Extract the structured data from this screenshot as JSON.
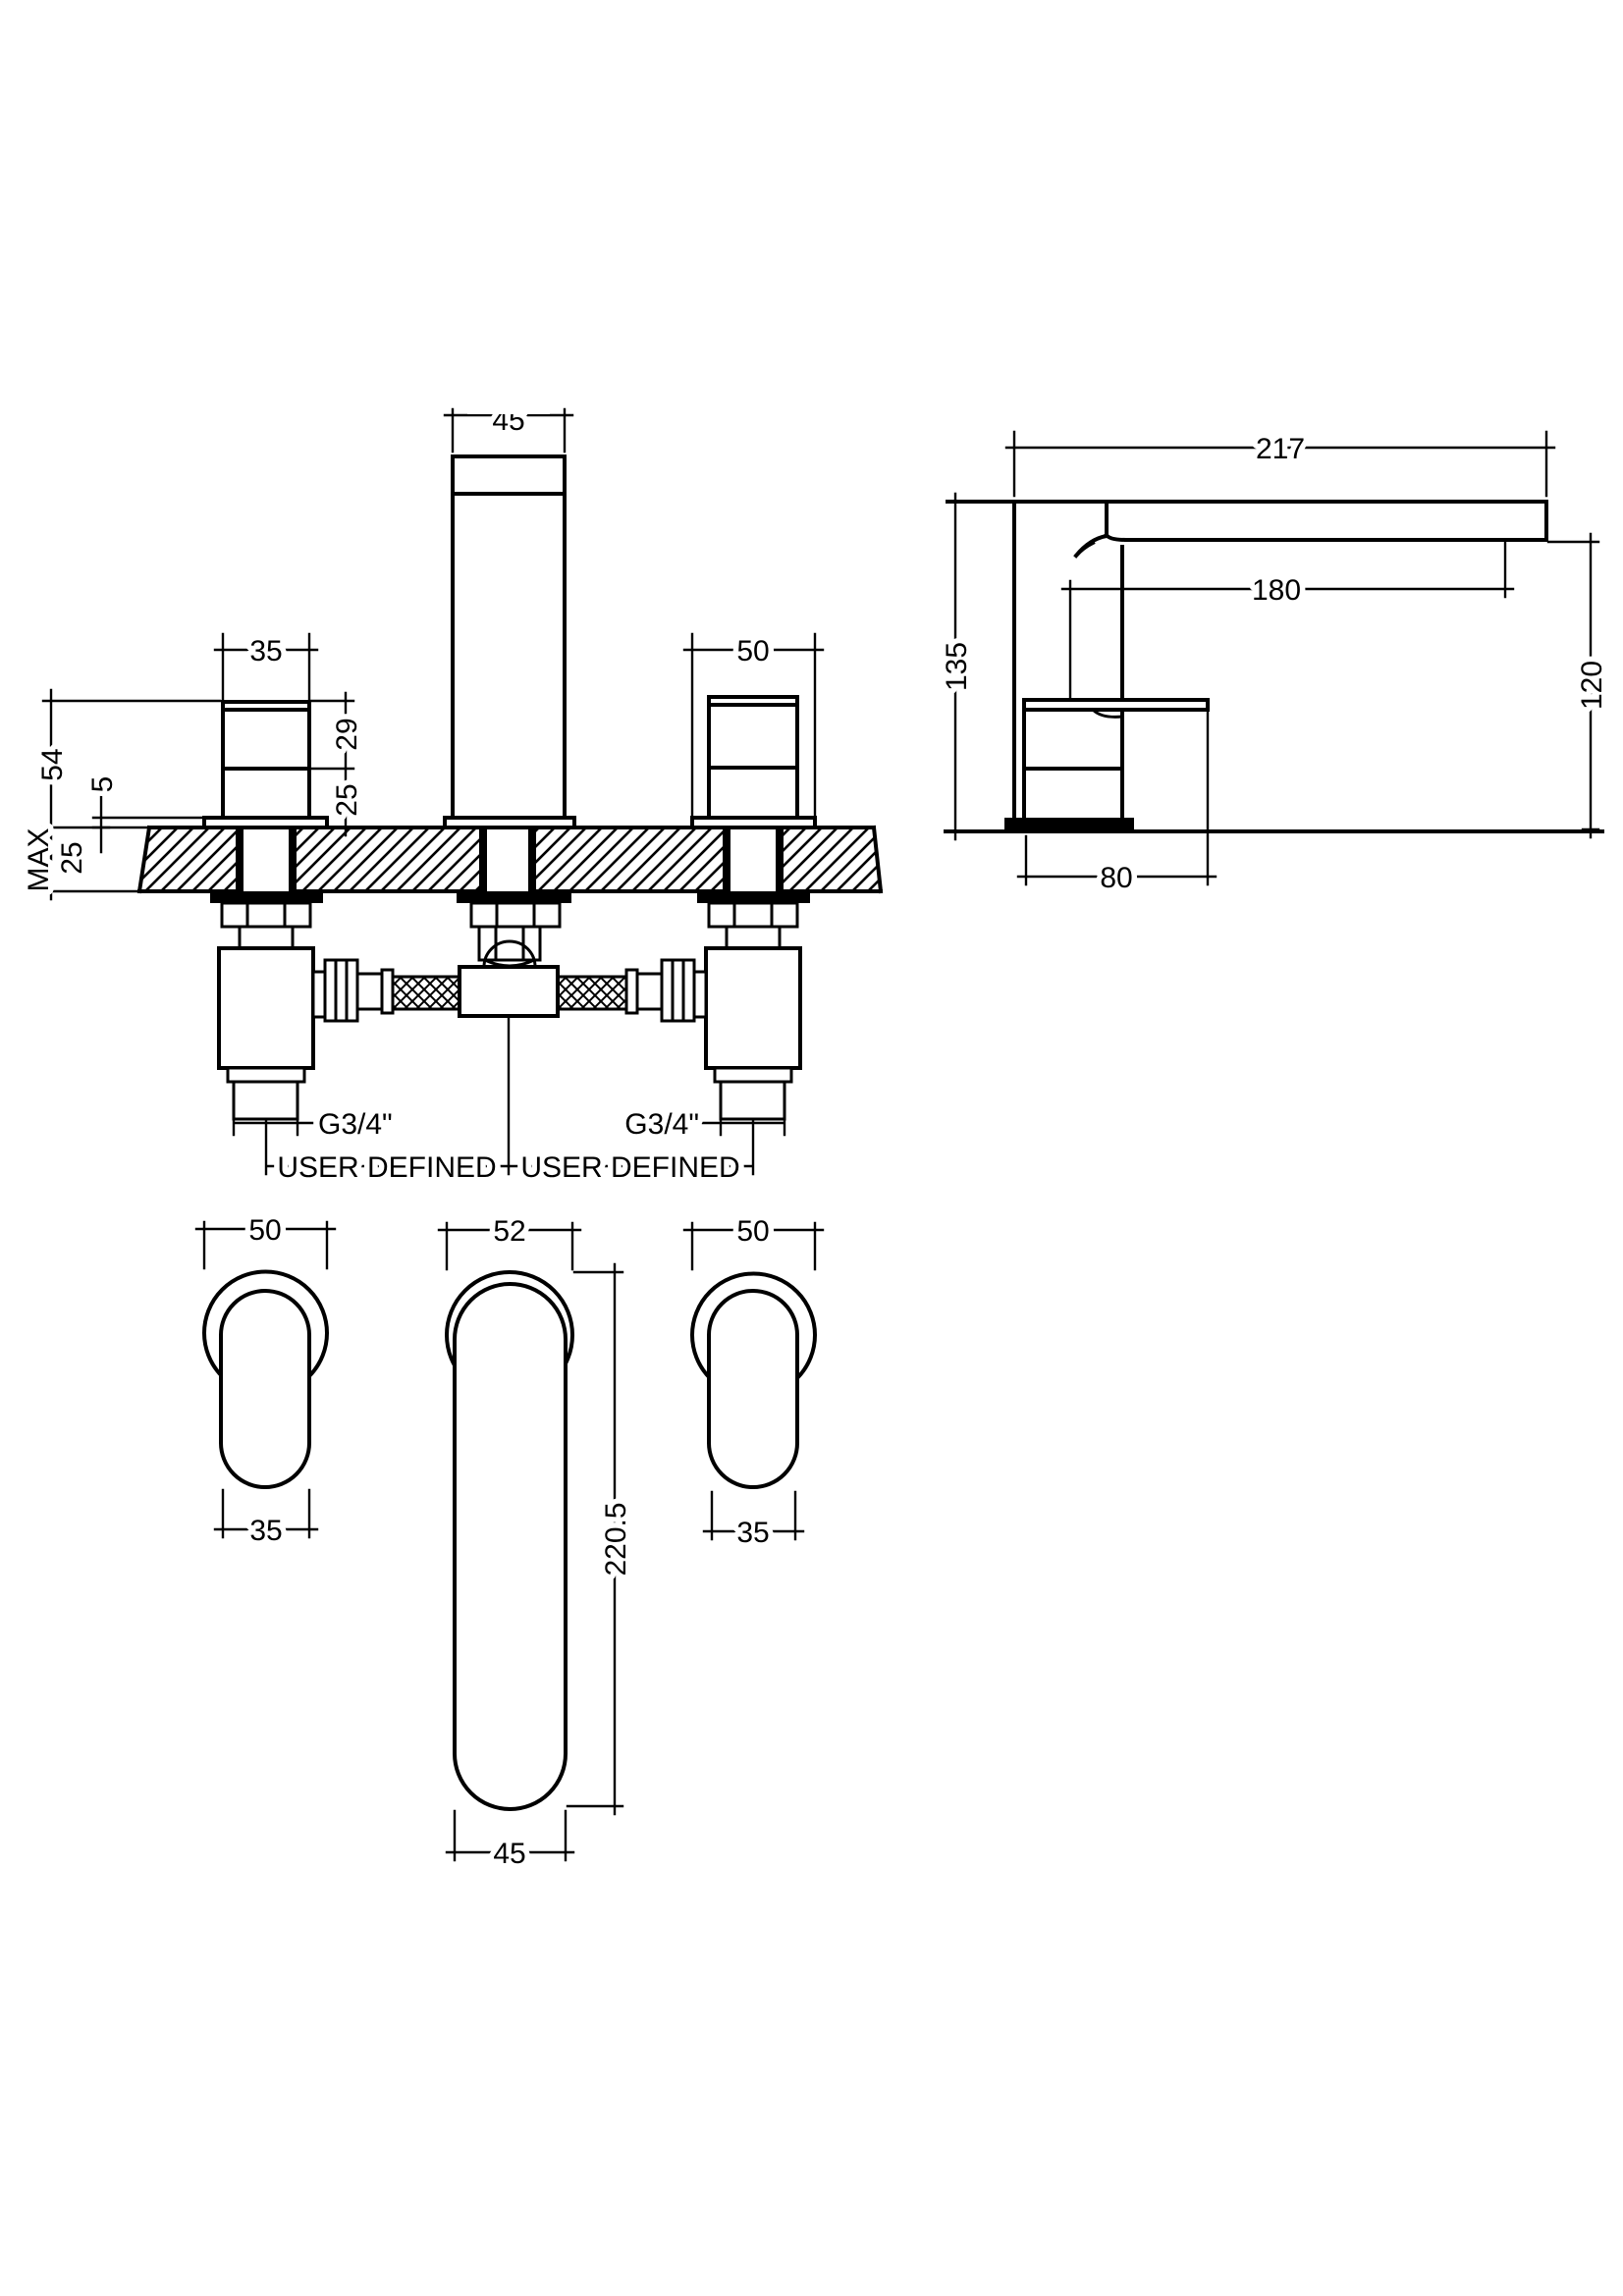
{
  "drawing": {
    "type": "technical-dimension-drawing",
    "subject": "3-hole deck mounted bath filler tap",
    "units": "mm",
    "front_view": {
      "spout_width": "45",
      "left_handle_width": "35",
      "right_handle_width": "50",
      "height_above_deck": "54",
      "base_plate_height": "5",
      "deck_max_label": "MAX",
      "deck_thickness": "25",
      "handle_upper_height": "29",
      "handle_lower_height": "25",
      "thread_left": "G3/4\"",
      "thread_right": "G3/4\"",
      "spacing_left": "USER DEFINED",
      "spacing_right": "USER DEFINED"
    },
    "side_view": {
      "overall_length": "217",
      "spout_reach": "180",
      "overall_height": "135",
      "spout_height": "120",
      "base_depth": "80"
    },
    "plan_view": {
      "left_plate_diameter": "50",
      "left_lever_width": "35",
      "spout_plate_diameter": "52",
      "spout_overall_length": "220.5",
      "spout_lever_width": "45",
      "right_plate_diameter": "50",
      "right_lever_width": "35"
    }
  }
}
